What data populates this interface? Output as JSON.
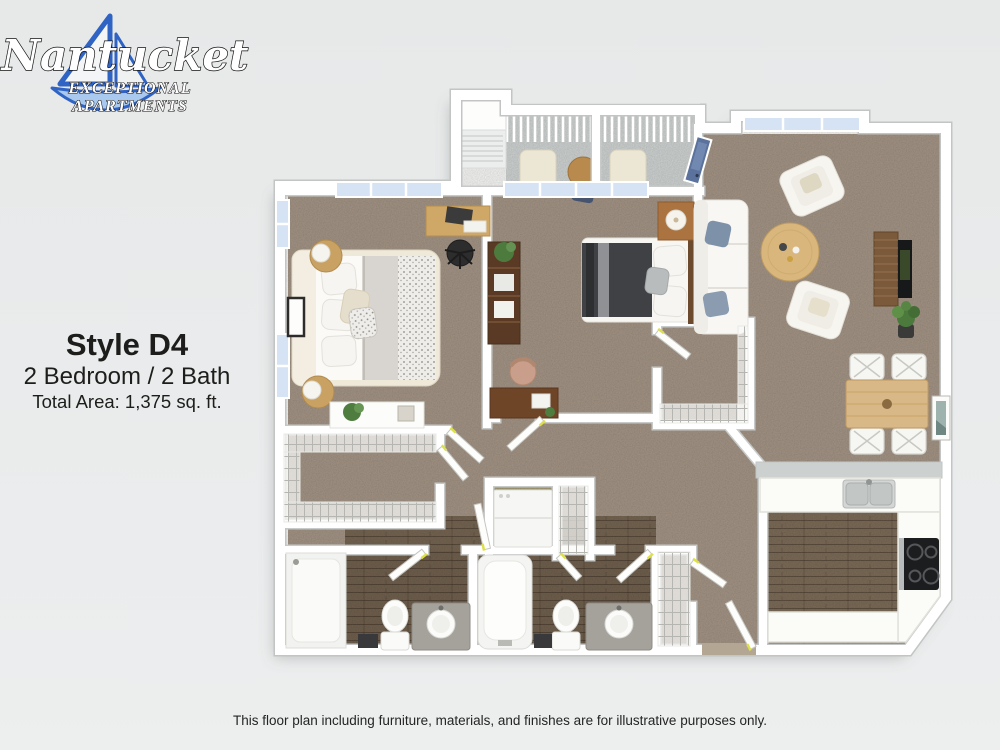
{
  "logo": {
    "name": "Nantucket",
    "tagline_line1": "EXCEPTIONAL",
    "tagline_line2": "APARTMENTS",
    "sail_color": "#2f63c4",
    "hull_color": "#a9c9ef"
  },
  "plan_info": {
    "style_name": "Style D4",
    "configuration": "2 Bedroom / 2 Bath",
    "total_area": "Total Area: 1,375 sq. ft."
  },
  "footer": {
    "disclaimer": "This floor plan including furniture, materials, and finishes are for illustrative purposes only."
  },
  "palette": {
    "background": "#e8eaea",
    "carpet": "#a29384",
    "kitchen_wood": "#7b6a57",
    "bath_wood": "#6f5f4d",
    "laundry_floor": "#a49a74",
    "balcony_concrete": "#cdd1d0",
    "wall": "#ffffff",
    "wall_edge": "#c7cac9",
    "window_glass": "#d5e3f4",
    "counter_gray": "#ccd0cf",
    "door_hinge_mark": "#dde04a",
    "text": "#1d1d1b"
  },
  "floor_plan": {
    "depicted_rooms": [
      "bedroom 1",
      "bedroom 2",
      "living room",
      "dining area",
      "kitchen",
      "bathroom 1",
      "bathroom 2",
      "walk-in closet 1",
      "walk-in closet 2",
      "laundry closet",
      "linen closet",
      "coat closet",
      "entry",
      "balcony"
    ]
  }
}
